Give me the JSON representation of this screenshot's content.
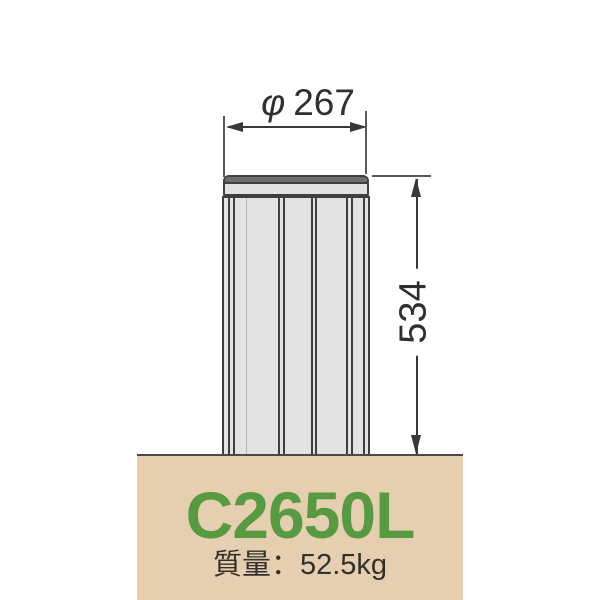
{
  "dimensions": {
    "diameter": {
      "symbol": "φ",
      "value": "267"
    },
    "height": {
      "value": "534"
    }
  },
  "product": {
    "model": "C2650L",
    "weight": "質量：52.5kg"
  },
  "colors": {
    "ground_fill": "#e6cfb1",
    "model_green": "#569a42",
    "line_dark": "#3f3f3f",
    "body_fill": "#e3e3e3",
    "cap_top_fill": "#6e6e6e",
    "weight_text": "#33302b"
  }
}
